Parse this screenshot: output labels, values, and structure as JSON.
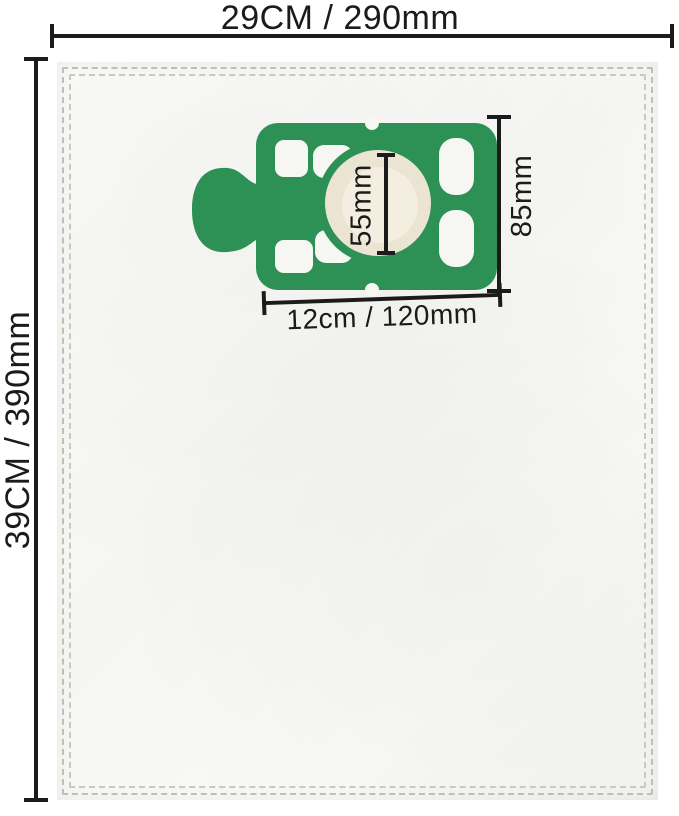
{
  "dimensions": {
    "bag_width": {
      "label": "29CM / 290mm"
    },
    "bag_height": {
      "label": "39CM / 390mm"
    },
    "plate_width": {
      "label": "12cm / 120mm"
    },
    "plate_height": {
      "label": "85mm"
    },
    "hole_diameter": {
      "label": "55mm"
    }
  },
  "colors": {
    "plate-green": "#2d9054",
    "hole-cream": "#ece4d3",
    "bag-white": "#f7f7f4",
    "stitch-grey": "#bfbfb8",
    "dim-black": "#1b1b1b"
  }
}
